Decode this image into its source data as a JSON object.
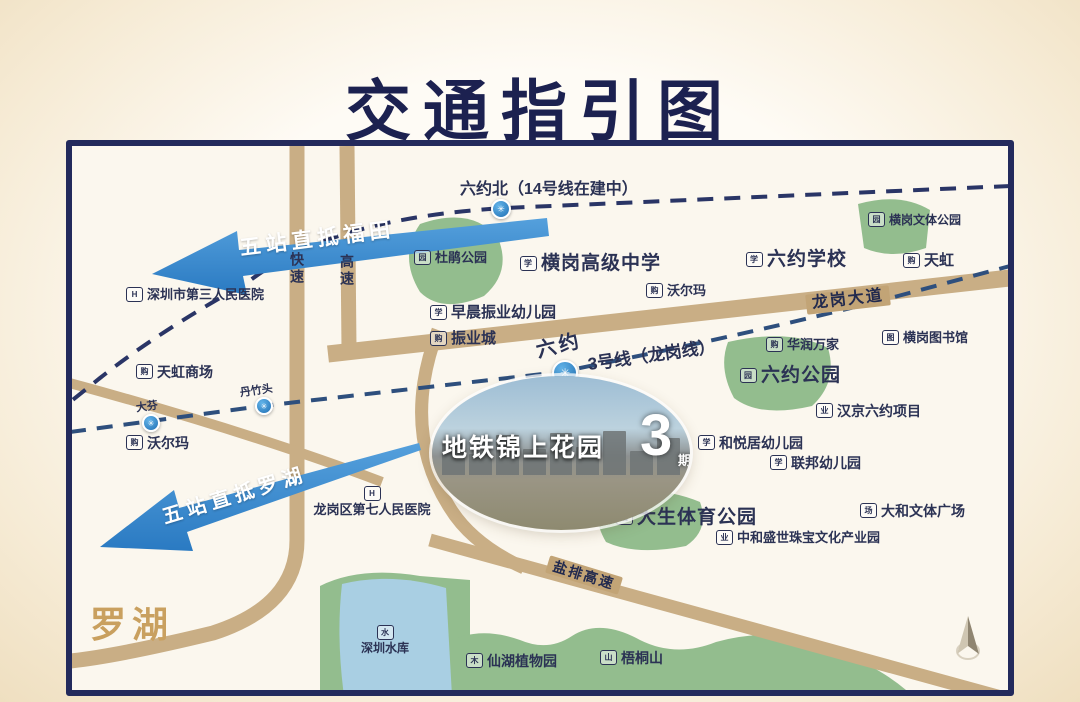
{
  "title": "交通指引图",
  "district_label": "罗湖",
  "arrows": {
    "futian": "五站直抵福田",
    "luohu": "五站直抵罗湖"
  },
  "metro": {
    "line14_station_label": "六约北（14号线在建中）",
    "line3_label": "3号线（龙岗线）",
    "station_glyph": "✳",
    "stations": {
      "dafen": "大芬",
      "danzhutou": "丹竹头",
      "liuyue": "六约"
    }
  },
  "roads": {
    "express_left": "快速",
    "express_right": "高速",
    "longgang_avenue": "龙岗大道",
    "yanpai_expressway": "盐排高速"
  },
  "property": {
    "name": "地铁锦上花园",
    "phase_number": "3",
    "phase_suffix": "期"
  },
  "pois": {
    "hospital3": {
      "icon_glyph": "H",
      "label": "深圳市第三人民医院"
    },
    "tianhong_mall": {
      "icon_glyph": "购",
      "label": "天虹商场"
    },
    "walmart_west": {
      "icon_glyph": "购",
      "label": "沃尔玛"
    },
    "dujuan_park": {
      "icon_glyph": "园",
      "label": "杜鹃公园"
    },
    "zaochen_kindergarten": {
      "icon_glyph": "学",
      "label": "早晨振业幼儿园"
    },
    "zhenye_city": {
      "icon_glyph": "购",
      "label": "振业城"
    },
    "henggang_high_school": {
      "icon_glyph": "学",
      "label": "横岗高级中学"
    },
    "walmart_east": {
      "icon_glyph": "购",
      "label": "沃尔玛"
    },
    "liuyue_school": {
      "icon_glyph": "学",
      "label": "六约学校"
    },
    "tianhong": {
      "icon_glyph": "购",
      "label": "天虹"
    },
    "henggang_culture_park": {
      "icon_glyph": "园",
      "label": "横岗文体公园"
    },
    "huarun_wanjia": {
      "icon_glyph": "购",
      "label": "华润万家"
    },
    "henggang_library": {
      "icon_glyph": "图",
      "label": "横岗图书馆"
    },
    "liuyue_park": {
      "icon_glyph": "园",
      "label": "六约公园"
    },
    "hanjing_project": {
      "icon_glyph": "业",
      "label": "汉京六约项目"
    },
    "heyueju_kindergarten": {
      "icon_glyph": "学",
      "label": "和悦居幼儿园"
    },
    "lianbang_kindergarten": {
      "icon_glyph": "学",
      "label": "联邦幼儿园"
    },
    "dasheng_sports_park": {
      "icon_glyph": "园",
      "label": "大生体育公园"
    },
    "dahe_plaza": {
      "icon_glyph": "场",
      "label": "大和文体广场"
    },
    "zhonghe_industry_park": {
      "icon_glyph": "业",
      "label": "中和盛世珠宝文化产业园"
    },
    "hospital7": {
      "icon_glyph": "H",
      "label": "龙岗区第七人民医院"
    },
    "shenzhen_reservoir": {
      "icon_glyph": "水",
      "label": "深圳水库"
    },
    "xianhu_garden": {
      "icon_glyph": "木",
      "label": "仙湖植物园"
    },
    "wutong_mountain": {
      "icon_glyph": "山",
      "label": "梧桐山"
    }
  },
  "colors": {
    "accent_navy": "#1c2150",
    "road_tan": "#c9ae85",
    "park_green": "#93bd8e",
    "water_blue": "#a9cfe3",
    "arrow_blue": "#3f8fd2",
    "metro_line14": "#2a3566",
    "metro_line3": "#2e4f7d"
  }
}
